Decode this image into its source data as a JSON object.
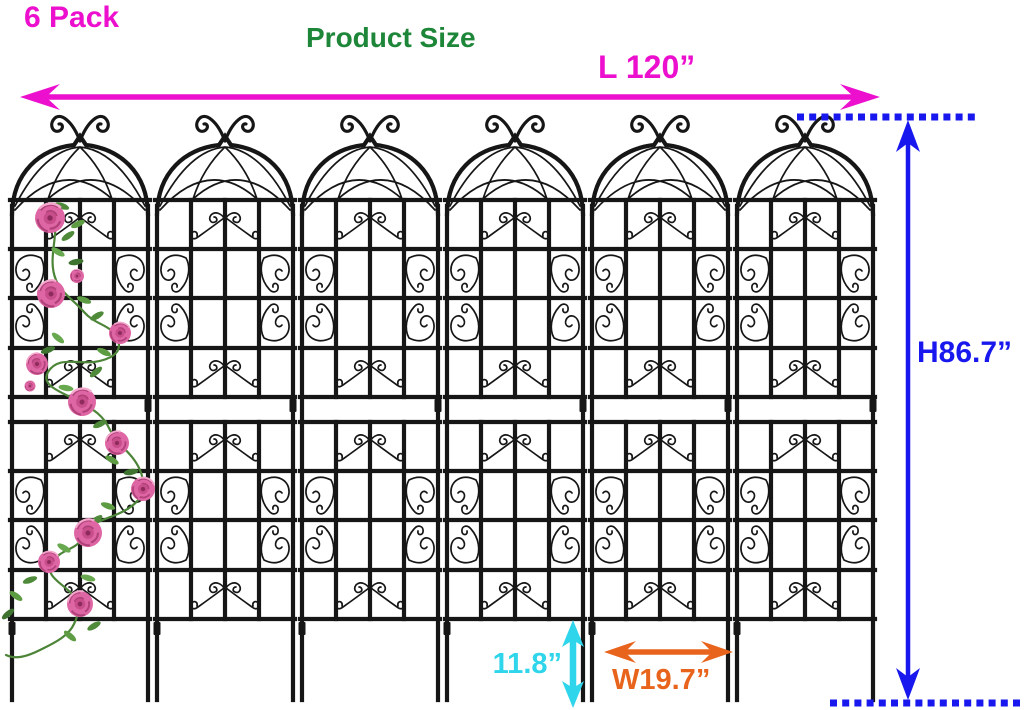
{
  "labels": {
    "pack_count": "6 Pack",
    "product_title": "Product Size",
    "length": "L 120”",
    "height": "H86.7”",
    "ground_stake_height": "11.8”",
    "panel_width": "W19.7”"
  },
  "trellis": {
    "panel_count": 6,
    "description": "black metal garden trellis panels with arched scroll tops",
    "decoration": "pink climbing roses on first panel"
  },
  "colors": {
    "annotation_magenta": "#EC10CE",
    "title_green": "#1E8639",
    "dimension_blue": "#1717EE",
    "stake_cyan": "#2FD5EA",
    "width_orange": "#E8641C",
    "trellis_black": "#161616",
    "rose_pink": "#DE66A4",
    "leaf_green": "#4C8438"
  }
}
